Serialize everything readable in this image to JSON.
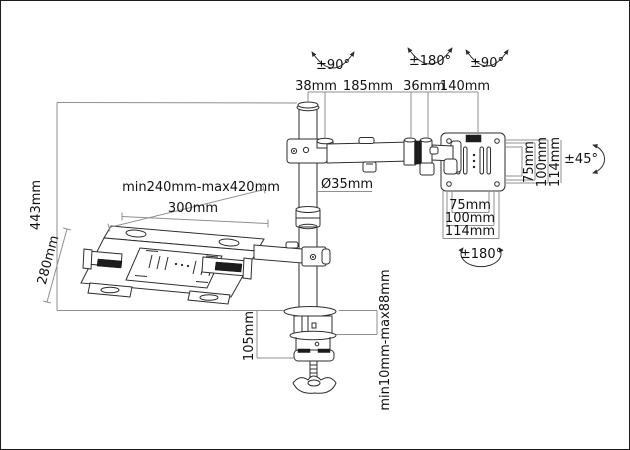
{
  "diagram": {
    "type": "technical-dimension-drawing",
    "subject": "desk-clamp laptop/monitor arm with pole, articulated arm, VESA plate and notebook tray"
  },
  "labels": {
    "rotation_pole_top": "±90°",
    "rotation_elbow_top": "±180°",
    "rotation_vesa_top": "±90°",
    "arm_segment_1": "38mm",
    "arm_segment_2": "185mm",
    "arm_segment_3": "36mm",
    "arm_segment_4": "140mm",
    "pole_height": "443mm",
    "tray_adjust_range": "min240mm-max420mm",
    "tray_width": "300mm",
    "tray_depth": "280mm",
    "pole_diameter": "Ø35mm",
    "vesa_vertical": [
      "75mm",
      "100mm",
      "114mm"
    ],
    "vesa_tilt": "±45°",
    "vesa_horizontal": [
      "75mm",
      "100mm",
      "114mm"
    ],
    "vesa_rotation": "±180°",
    "clamp_height": "105mm",
    "clamp_range": "min10mm-max88mm"
  },
  "colors": {
    "background": "#ffffff",
    "part_line": "#2e2e2e",
    "dimension_line": "#8f8f8f",
    "text": "#111111",
    "pad_fill": "#1c1c1c"
  }
}
